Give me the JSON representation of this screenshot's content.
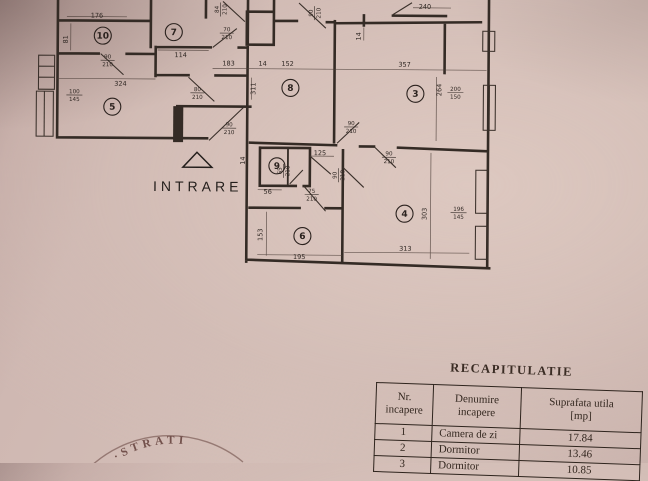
{
  "floorplan": {
    "entrance_label": "INTRARE",
    "rooms": [
      {
        "n": "10"
      },
      {
        "n": "7"
      },
      {
        "n": "5"
      },
      {
        "n": "8"
      },
      {
        "n": "3"
      },
      {
        "n": "9"
      },
      {
        "n": "6"
      },
      {
        "n": "4"
      }
    ],
    "dims": [
      {
        "t": "176"
      },
      {
        "t": "81"
      },
      {
        "t": "114"
      },
      {
        "t": "183"
      },
      {
        "t": "14"
      },
      {
        "t": "152"
      },
      {
        "t": "357"
      },
      {
        "t": "324"
      },
      {
        "t": "240"
      },
      {
        "t": "14"
      },
      {
        "t": "311"
      },
      {
        "t": "264"
      },
      {
        "t": "125"
      },
      {
        "t": "56"
      },
      {
        "t": "153"
      },
      {
        "t": "195"
      },
      {
        "t": "313"
      },
      {
        "t": "303"
      },
      {
        "t": "14"
      }
    ],
    "doors": [
      {
        "w": "90",
        "h": "210"
      },
      {
        "w": "70",
        "h": "210"
      },
      {
        "w": "84",
        "h": "210"
      },
      {
        "w": "90",
        "h": "210"
      },
      {
        "w": "80",
        "h": "210"
      },
      {
        "w": "90",
        "h": "210"
      },
      {
        "w": "90",
        "h": "210"
      },
      {
        "w": "90",
        "h": "210"
      },
      {
        "w": "75",
        "h": "210"
      },
      {
        "w": "90",
        "h": "210"
      },
      {
        "w": "100",
        "h": "145"
      },
      {
        "w": "200",
        "h": "150"
      },
      {
        "w": "196",
        "h": "145"
      },
      {
        "w": "65",
        "h": "210"
      }
    ]
  },
  "stamp": {
    "text": "·STRATI"
  },
  "recap": {
    "title": "RECAPITULATIE",
    "columns": [
      {
        "l1": "Nr.",
        "l2": "incapere"
      },
      {
        "l1": "Denumire",
        "l2": "incapere"
      },
      {
        "l1": "Suprafata utila",
        "l2": "[mp]"
      }
    ],
    "rows": [
      {
        "nr": "1",
        "name": "Camera de zi",
        "area": "17.84"
      },
      {
        "nr": "2",
        "name": "Dormitor",
        "area": "13.46"
      },
      {
        "nr": "3",
        "name": "Dormitor",
        "area": "10.85"
      }
    ]
  }
}
